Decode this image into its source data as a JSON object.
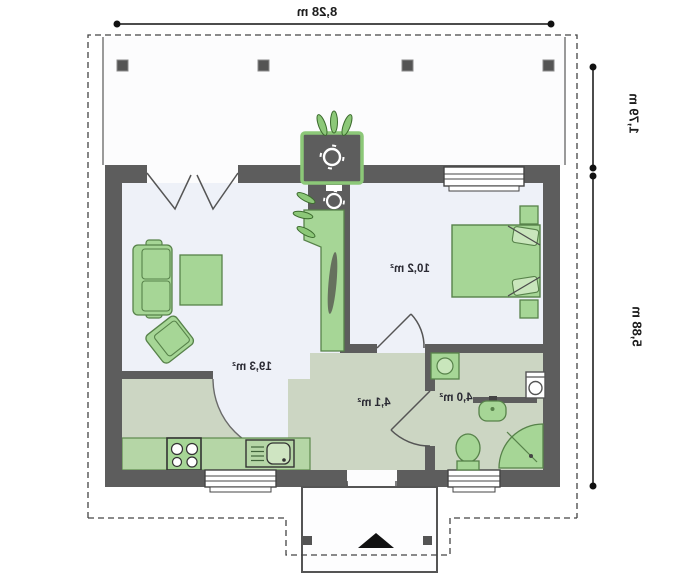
{
  "plan": {
    "dimensions": {
      "width_top": "8,28 m",
      "porch_depth": "1,79 m",
      "house_depth": "5,88 m"
    },
    "rooms": {
      "living_kitchen": {
        "area": "19,3 m²"
      },
      "bedroom": {
        "area": "10,2 m²"
      },
      "hall": {
        "area": "4,1 m²"
      },
      "bathroom": {
        "area": "4,0 m²"
      }
    },
    "colors": {
      "wall": "#5d5d5d",
      "furniture_green": "#a6d696",
      "room_sage": "#ccd6c3",
      "floor_light": "#eef1f8",
      "chimney_outline": "#8cc878"
    }
  }
}
